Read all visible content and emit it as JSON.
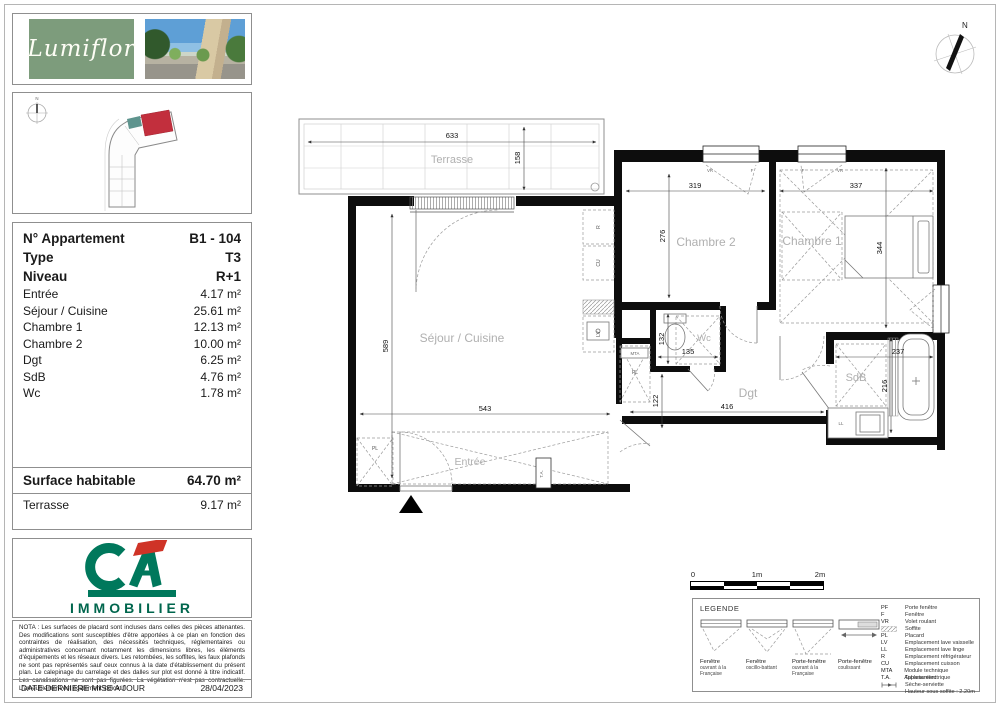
{
  "branding": {
    "name": "Lumiflor"
  },
  "site_plan": {
    "north_label": "N"
  },
  "info": {
    "header": [
      {
        "label": "N° Appartement",
        "value": "B1 - 104"
      },
      {
        "label": "Type",
        "value": "T3"
      },
      {
        "label": "Niveau",
        "value": "R+1"
      }
    ],
    "rooms": [
      {
        "label": "Entrée",
        "value": "4.17 m²"
      },
      {
        "label": "Séjour / Cuisine",
        "value": "25.61 m²"
      },
      {
        "label": "Chambre 1",
        "value": "12.13 m²"
      },
      {
        "label": "Chambre 2",
        "value": "10.00 m²"
      },
      {
        "label": "Dgt",
        "value": "6.25 m²"
      },
      {
        "label": "SdB",
        "value": "4.76 m²"
      },
      {
        "label": "Wc",
        "value": "1.78 m²"
      }
    ],
    "summary": [
      {
        "label": "Surface habitable",
        "value": "64.70 m²"
      },
      {
        "label": "Terrasse",
        "value": "9.17 m²"
      }
    ]
  },
  "agency": {
    "monogram": "CA",
    "label": "IMMOBILIER"
  },
  "nota": {
    "text": "NOTA : Les surfaces de placard sont incluses dans celles des pièces attenantes. Des modifications sont susceptibles d'être apportées à ce plan en fonction des contraintes de réalisation, des nécessités techniques, réglementaires ou administratives concernant notamment les dimensions libres, les éléments d'équipements et les réseaux divers. Les retombées, les soffites, les faux plafonds ne sont pas représentés sauf ceux connus à la date d'établissement du présent plan. Le calepinage du carrelage et des dalles sur plot est donné à titre indicatif. Les canalisations ne sont pas figurées. La végétation n'est pas contractuelle. L'ameublement est également indicatif.",
    "date_label": "DATE DERNIERE MISE A JOUR",
    "date_value": "28/04/2023"
  },
  "plan": {
    "north_label": "N",
    "rooms": {
      "terrasse": "Terrasse",
      "sejour": "Séjour / Cuisine",
      "chambre2": "Chambre 2",
      "chambre1": "Chambre 1",
      "wc": "Wc",
      "dgt": "Dgt",
      "sdb": "SdB",
      "entree": "Entrée"
    },
    "dims": {
      "terrasse_w": "633",
      "terrasse_d": "158",
      "sejour_h": "589",
      "sejour_w": "543",
      "ch2_w": "319",
      "ch2_d": "276",
      "ch1_w": "337",
      "ch1_d": "344",
      "wc_w": "135",
      "wc_h": "132",
      "dgt_w": "416",
      "dgt_h": "122",
      "sdb_w": "237",
      "sdb_d": "216"
    },
    "tags": {
      "mta": "MTA",
      "pl": "PL",
      "ta": "T.A.",
      "r": "R",
      "cu": "CU",
      "lv": "LV",
      "ll": "LL",
      "vr": "VR",
      "f": "F"
    }
  },
  "scale_bar": {
    "ticks": [
      "0",
      "1m",
      "2m"
    ]
  },
  "legend": {
    "title": "LEGENDE",
    "window_types": [
      {
        "title": "Fenêtre",
        "subtitle": "ouvrant à la Française"
      },
      {
        "title": "Fenêtre",
        "subtitle": "oscillo-battant"
      },
      {
        "title": "Porte-fenêtre",
        "subtitle": "ouvrant à la Française"
      },
      {
        "title": "Porte-fenêtre",
        "subtitle": "coulissant"
      }
    ],
    "abbreviations": [
      {
        "code": "PF",
        "label": "Porte fenêtre"
      },
      {
        "code": "F",
        "label": "Fenêtre"
      },
      {
        "code": "VR",
        "label": "Volet roulant"
      },
      {
        "code": "",
        "label": "Soffite"
      },
      {
        "code": "PL",
        "label": "Placard"
      },
      {
        "code": "LV",
        "label": "Emplacement lave vaisselle"
      },
      {
        "code": "LL",
        "label": "Emplacement lave linge"
      },
      {
        "code": "R",
        "label": "Emplacement réfrigérateur"
      },
      {
        "code": "CU",
        "label": "Emplacement cuisson"
      },
      {
        "code": "MTA",
        "label": "Module technique Appartement"
      },
      {
        "code": "T.A.",
        "label": "Tableau électrique"
      },
      {
        "code": "",
        "label": "Sèche-serviette"
      },
      {
        "code": "",
        "label": "Hauteur sous soffite : 2.20m"
      }
    ]
  }
}
